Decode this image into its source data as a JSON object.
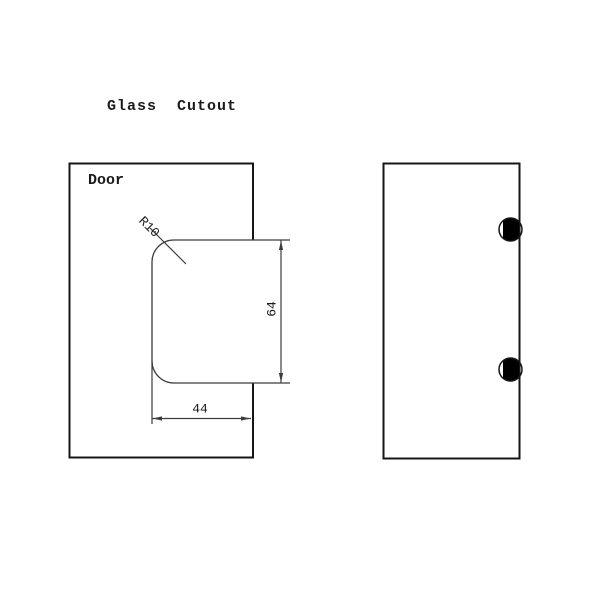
{
  "drawing": {
    "title": "Glass  Cutout",
    "door_label": "Door",
    "dimensions": {
      "corner_radius": "R10",
      "cutout_height": "64",
      "cutout_width": "44"
    },
    "side_view": {
      "fastener_count": 2
    },
    "colors": {
      "outline": "#161616",
      "thin_line": "#3c3c3c",
      "background": "#ffffff",
      "fastener_fill": "#000000",
      "text": "#1a1a1a"
    }
  }
}
